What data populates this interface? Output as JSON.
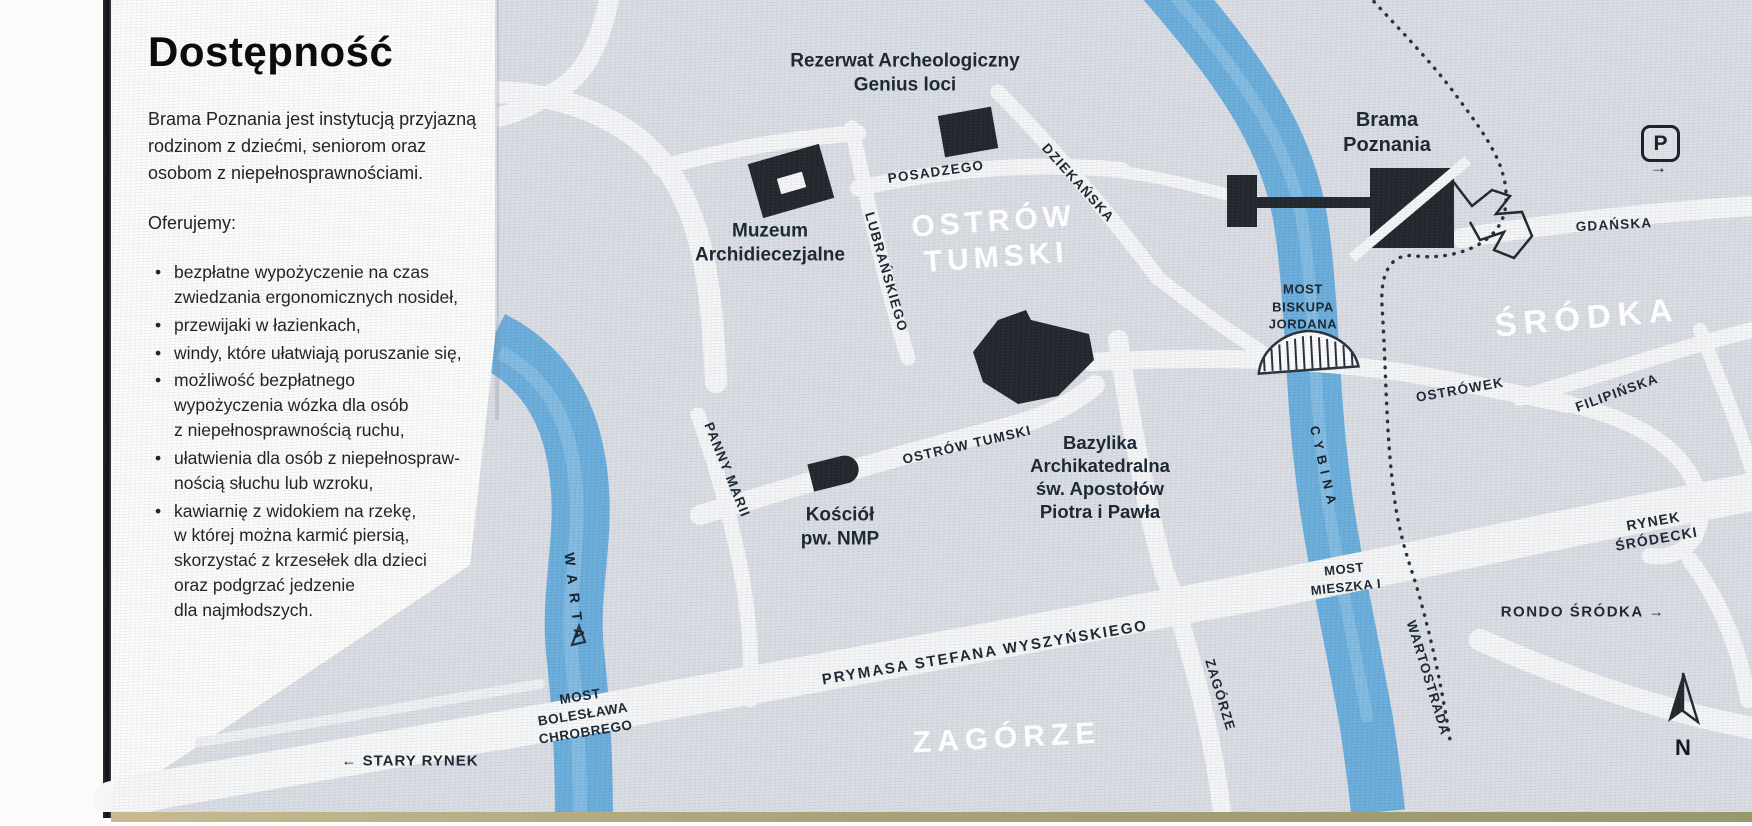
{
  "panel": {
    "title": "Dostępność",
    "intro": "Brama Poznania jest instytucją przyjazną\nrodzinom z dziećmi, seniorom oraz\nosobom z niepełnosprawnościami.",
    "offer_heading": "Oferujemy:",
    "bullets": [
      "bezpłatne wypożyczenie na czas\nzwiedzania ergonomicznych nosideł,",
      "przewijaki w łazienkach,",
      "windy, które ułatwiają poruszanie się,",
      "możliwość bezpłatnego\nwypożyczenia wózka dla osób\nz niepełnosprawnością ruchu,",
      "ułatwienia dla osób z niepełnospraw-\nnością słuchu lub wzroku,",
      "kawiarnię z widokiem na rzekę,\nw której można karmić piersią,\nskorzystać z krzesełek dla dzieci\noraz podgrzać jedzenie\ndla najmłodszych."
    ]
  },
  "map": {
    "districts": {
      "ostrow_tumski": "OSTRÓW\nTUMSKI",
      "srodka": "ŚRÓDKA",
      "zagorze": "ZAGÓRZE"
    },
    "rivers": {
      "warta": "WARTA",
      "cybina": "CYBINA"
    },
    "streets": {
      "posadzego": "POSADZEGO",
      "lubranskiego": "LUBRAŃSKIEGO",
      "dziekanska": "DZIEKAŃSKA",
      "ostrow_tumski_st": "OSTRÓW TUMSKI",
      "panny_marii": "PANNY MARII",
      "gdanska": "GDAŃSKA",
      "ostrowek": "OSTRÓWEK",
      "filipinska": "FILIPIŃSKA",
      "prymasa": "PRYMASA STEFANA WYSZYŃSKIEGO",
      "zagorze_st": "ZAGÓRZE",
      "wartostrada": "WARTOSTRADA"
    },
    "bridges": {
      "jordana": "MOST\nBISKUPA\nJORDANA",
      "mieszka": "MOST\nMIESZKA I",
      "chrobrego": "MOST\nBOLESŁAWA\nCHROBREGO"
    },
    "pois": {
      "rezerwat": "Rezerwat Archeologiczny\nGenius loci",
      "muzeum": "Muzeum\nArchidiecezjalne",
      "bazylika": "Bazylika\nArchikatedralna\nśw. Apostołów\nPiotra i Pawła",
      "kosciol": "Kościół\npw. NMP",
      "brama": "Brama\nPoznania"
    },
    "places": {
      "rynek_srodecki": "RYNEK\nŚRÓDECKI",
      "rondo_srodka": "RONDO ŚRÓDKA →",
      "stary_rynek": "← STARY RYNEK"
    },
    "parking": {
      "label": "P",
      "arrow": "→"
    },
    "compass": {
      "north": "N"
    }
  },
  "colors": {
    "water": "#62a9da",
    "water_light": "#8fc3e5",
    "map_bg": "#d9dce2",
    "street": "#f5f6f7",
    "ink": "#1d2935",
    "district_text": "#ffffff",
    "page_edge_tan": "#a8a377"
  }
}
